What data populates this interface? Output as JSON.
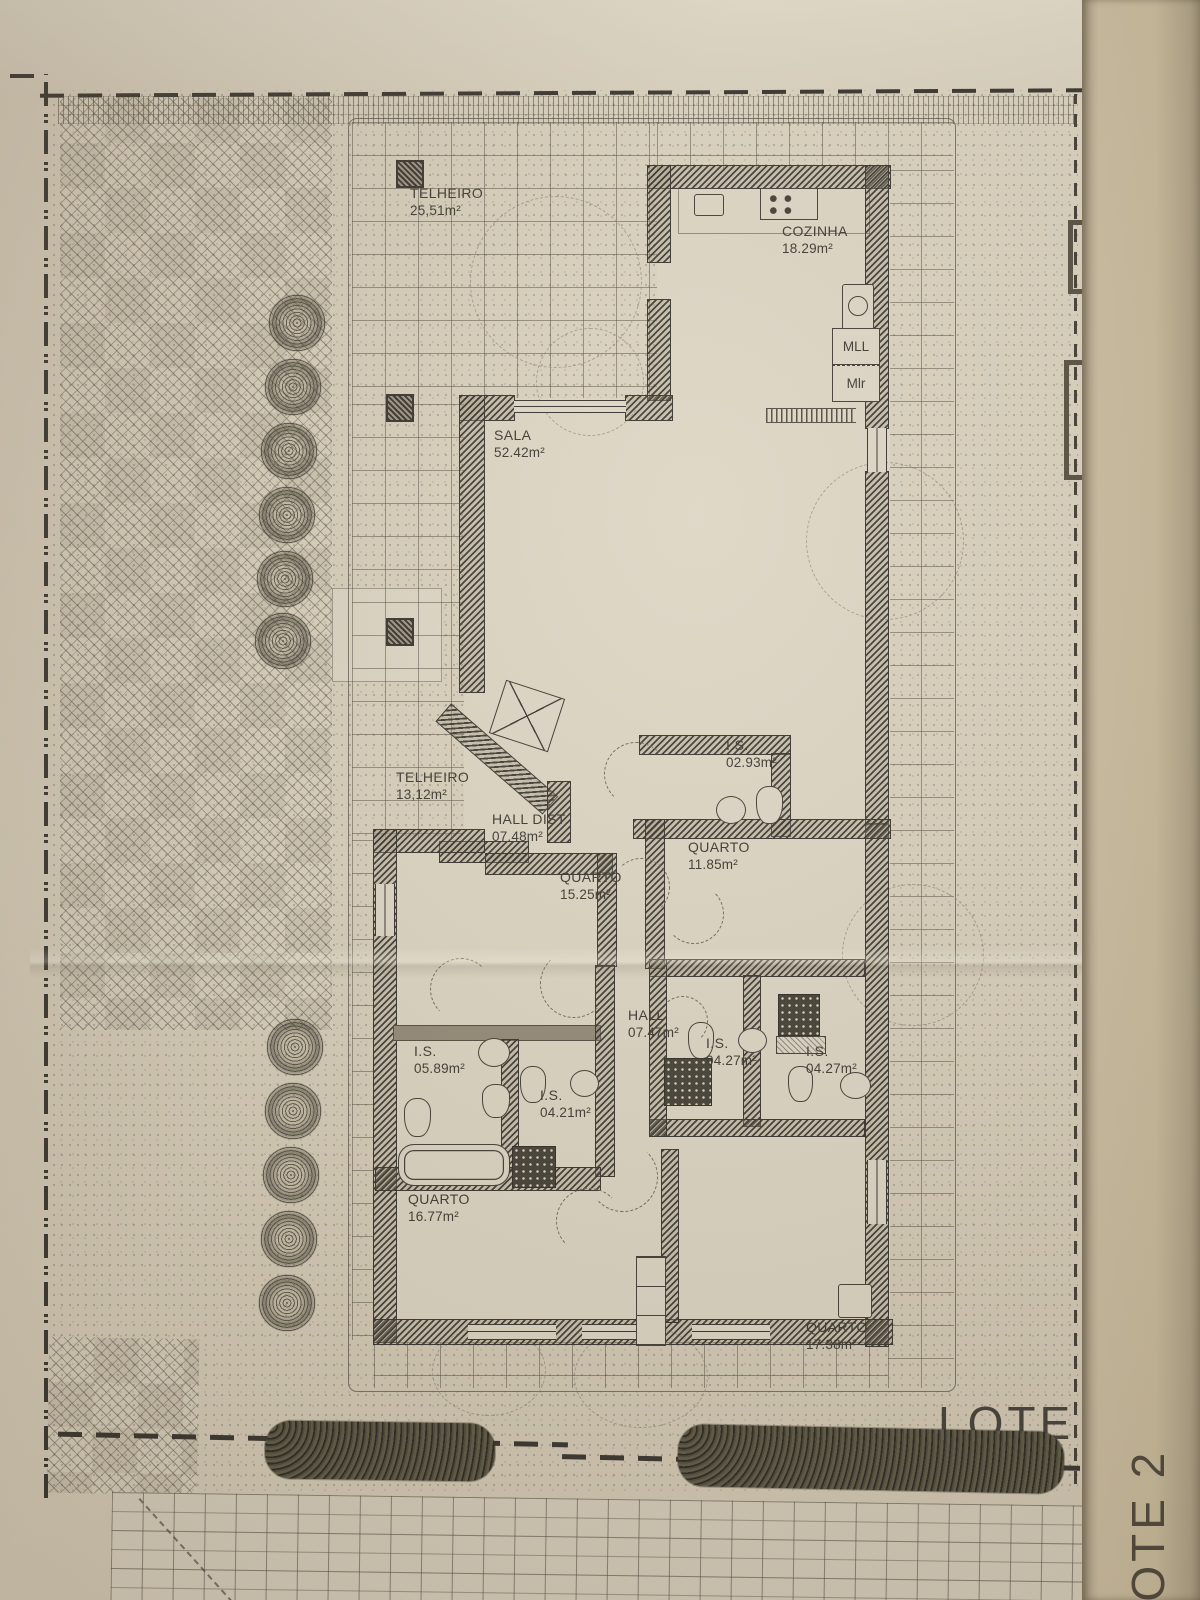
{
  "labels": {
    "lot1": "LOTE 1",
    "lot2": "LOTE 2"
  },
  "kitchen": {
    "mll": "MLL",
    "mlr": "Mlr"
  },
  "rooms": [
    {
      "name": "TELHEIRO",
      "area": "25,51m²"
    },
    {
      "name": "COZINHA",
      "area": "18.29m²"
    },
    {
      "name": "SALA",
      "area": "52.42m²"
    },
    {
      "name": "TELHEIRO",
      "area": "13,12m²"
    },
    {
      "name": "HALL DIST.",
      "area": "07.48m²"
    },
    {
      "name": "I.S.",
      "area": "02.93m²"
    },
    {
      "name": "QUARTO",
      "area": "11.85m²"
    },
    {
      "name": "QUARTO",
      "area": "15.25m²"
    },
    {
      "name": "HALL",
      "area": "07.47m²"
    },
    {
      "name": "I.S.",
      "area": "05.89m²"
    },
    {
      "name": "I.S.",
      "area": "04.21m²"
    },
    {
      "name": "I.S.",
      "area": "04.27m²"
    },
    {
      "name": "I.S.",
      "area": "04.27m²"
    },
    {
      "name": "QUARTO",
      "area": "16.77m²"
    },
    {
      "name": "QUARTO",
      "area": "17.38m²"
    }
  ],
  "colors": {
    "paper": "#d8cfbc",
    "fold": "#c0b294",
    "ink": "#35312a",
    "wall": "#2e2b25"
  }
}
